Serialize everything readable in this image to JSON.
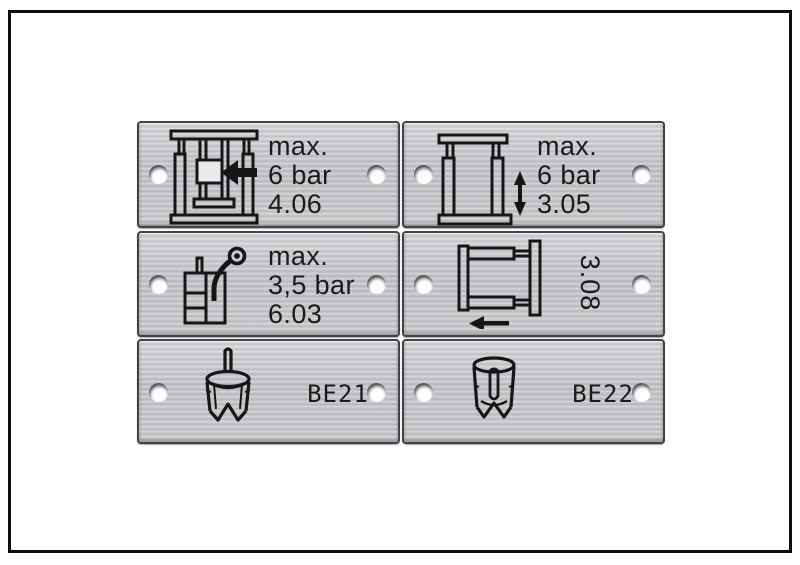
{
  "board": {
    "background_color": "#ffffff",
    "frame_color": "#0c0c0c",
    "plate_color": "#c9c9cd",
    "engraving_color": "#1a1a1a"
  },
  "plates": [
    {
      "icon": "press-feed-arrow-icon",
      "lines": [
        "max.",
        "6 bar",
        "4.06"
      ]
    },
    {
      "icon": "frame-vertical-stroke-arrow-icon",
      "lines": [
        "max.",
        "6 bar",
        "3.05"
      ]
    },
    {
      "icon": "container-spray-nozzle-icon",
      "lines": [
        "max.",
        "3,5 bar",
        "6.03"
      ]
    },
    {
      "icon": "frame-horizontal-stroke-arrow-icon",
      "lines": [
        "3.08"
      ],
      "text_rotated_90deg": true
    },
    {
      "icon": "suction-cup-pin-up-icon",
      "lines": [
        "BE21"
      ]
    },
    {
      "icon": "suction-cup-inner-pin-icon",
      "lines": [
        "BE22"
      ]
    }
  ]
}
